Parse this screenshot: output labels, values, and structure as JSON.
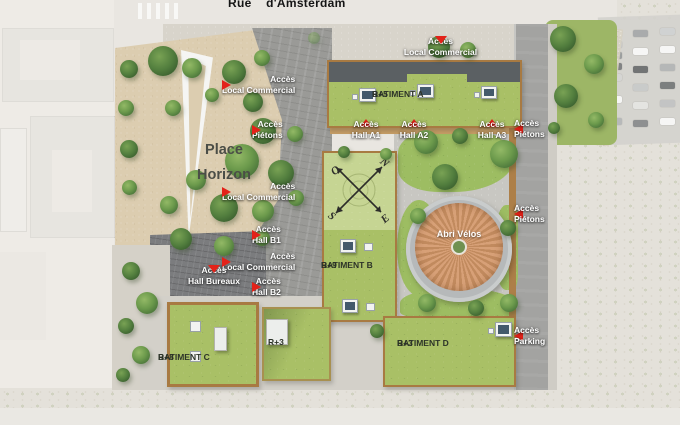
{
  "street_label": "Rue    d'Amsterdam",
  "place_label": "Place\nHorizon",
  "bike_shelter_label": "Abri Vélos",
  "buildings": {
    "a": {
      "name": "BATIMENT A",
      "level": "R+5"
    },
    "b": {
      "name": "BATIMENT B",
      "level": "R+9"
    },
    "c": {
      "name": "BATIMENT C",
      "level": "R+8"
    },
    "d": {
      "name": "BATIMENT D",
      "level": "R+3"
    },
    "annex": {
      "level": "R+3"
    }
  },
  "access": {
    "top_local_commercial": "Accès\nLocal Commercial",
    "left_local_commercial_1": "Accès\nLocal Commercial",
    "left_pietons": "Accès\nPiétons",
    "left_local_commercial_2": "Accès\nLocal Commercial",
    "hall_b1": "Accès\nHall B1",
    "left_local_commercial_3": "Accès\nLocal Commercial",
    "hall_b2": "Accès\nHall B2",
    "hall_a1": "Accès\nHall A1",
    "hall_a2": "Accès\nHall A2",
    "hall_a3": "Accès\nHall A3",
    "right_pietons_1": "Accès\nPiétons",
    "right_pietons_2": "Accès\nPiétons",
    "hall_bureaux": "Accès\nHall Bureaux",
    "parking": "Accès\nParking"
  },
  "compass": {
    "north": "N",
    "east": "E",
    "south": "S",
    "west": "O"
  },
  "colors": {
    "accent_red": "#e32219",
    "lawn_green": "#a9c066",
    "light_roof_green": "#c6d593",
    "wood_border": "#a87a42",
    "dark_roof": "#5b6063",
    "bike_shelter_roof": "#d7a077"
  }
}
